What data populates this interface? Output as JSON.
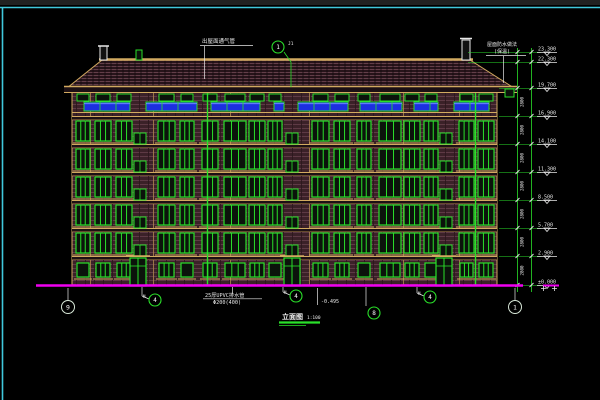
{
  "drawing": {
    "title": "立面图",
    "scale": "1:100",
    "notes": {
      "roof_vent_note": "出屋面通气管",
      "detail_tag_side": "J1",
      "roof_note_line1": "屋面防水做法",
      "roof_note_line2": "(保温)",
      "drain_note_line1": "25厚UPVC排水管",
      "drain_note_line2": "Φ200(400)",
      "grade_note": "-0.495"
    },
    "story_dimension": "2800",
    "levels": [
      {
        "y": 52,
        "label": "23.300"
      },
      {
        "y": 62,
        "label": "22.300"
      },
      {
        "y": 88,
        "label": "19.700"
      },
      {
        "y": 116,
        "label": "16.900"
      },
      {
        "y": 144,
        "label": "14.100"
      },
      {
        "y": 172,
        "label": "11.300"
      },
      {
        "y": 200,
        "label": "8.500"
      },
      {
        "y": 228,
        "label": "5.700"
      },
      {
        "y": 256,
        "label": "2.900"
      },
      {
        "y": 285,
        "label": "±0.000"
      }
    ],
    "axis_bubbles": [
      {
        "x": 68,
        "y": 307,
        "label": "9"
      },
      {
        "x": 515,
        "y": 307,
        "label": "1"
      }
    ],
    "detail_bubbles": [
      {
        "x": 155,
        "y": 300,
        "label": "4",
        "tag": "M"
      },
      {
        "x": 296,
        "y": 296,
        "label": "4",
        "tag": "M"
      },
      {
        "x": 430,
        "y": 297,
        "label": "4",
        "tag": "M"
      },
      {
        "x": 374,
        "y": 313,
        "label": "8",
        "tag": ""
      },
      {
        "x": 278,
        "y": 47,
        "label": "1",
        "tag": ""
      }
    ],
    "colors": {
      "line_green": "#2ae02a",
      "tan": "#d2aa60",
      "dark_tan": "#7c5e34",
      "magenta": "#f000f0",
      "blue_panel": "#1c2fe0",
      "blue_highlight": "#6b84ff",
      "frame_cyan": "#40c8dc",
      "wall_base": "#3b2128",
      "roof_base": "#27141a",
      "white": "#e8e8e8"
    },
    "building": {
      "wall": {
        "x": 72,
        "y": 88,
        "w": 425,
        "h": 198
      },
      "roof": {
        "e0": 67,
        "e1": 514,
        "r0": 102,
        "r1": 470,
        "ridge_y": 60,
        "eave_y": 88
      },
      "floor_bands": [
        116,
        144,
        172,
        200,
        228,
        256
      ],
      "window_rows": [
        121,
        149,
        177,
        205,
        233
      ],
      "win_h": 20,
      "cols": [
        [
          76,
          14
        ],
        [
          95,
          16
        ],
        [
          116,
          16
        ],
        [
          158,
          17
        ],
        [
          180,
          14
        ],
        [
          202,
          16
        ],
        [
          224,
          22
        ],
        [
          249,
          16
        ],
        [
          268,
          14
        ],
        [
          312,
          17
        ],
        [
          334,
          16
        ],
        [
          357,
          14
        ],
        [
          379,
          22
        ],
        [
          404,
          16
        ],
        [
          424,
          14
        ],
        [
          459,
          15
        ],
        [
          478,
          16
        ]
      ],
      "stair_xs": [
        134,
        286,
        440
      ],
      "stair_w": 12,
      "stair_rows": [
        133,
        161,
        189,
        217,
        245
      ],
      "stair_h": 11,
      "doors": [
        130,
        284,
        436
      ],
      "door_w": 16,
      "door_y": 258,
      "door_h": 28,
      "attic_y": 94,
      "attic_h": 7,
      "ground_y": 263,
      "ground_h": 14,
      "blue_band": {
        "y": 102,
        "h": 9,
        "segs": [
          [
            84,
            130
          ],
          [
            146,
            197
          ],
          [
            211,
            260
          ],
          [
            274,
            284
          ],
          [
            298,
            348
          ],
          [
            360,
            402
          ],
          [
            414,
            438
          ],
          [
            454,
            489
          ]
        ]
      },
      "pipes": [
        207,
        475
      ],
      "pilasters": [
        90,
        153,
        230,
        309,
        403,
        459
      ]
    }
  }
}
